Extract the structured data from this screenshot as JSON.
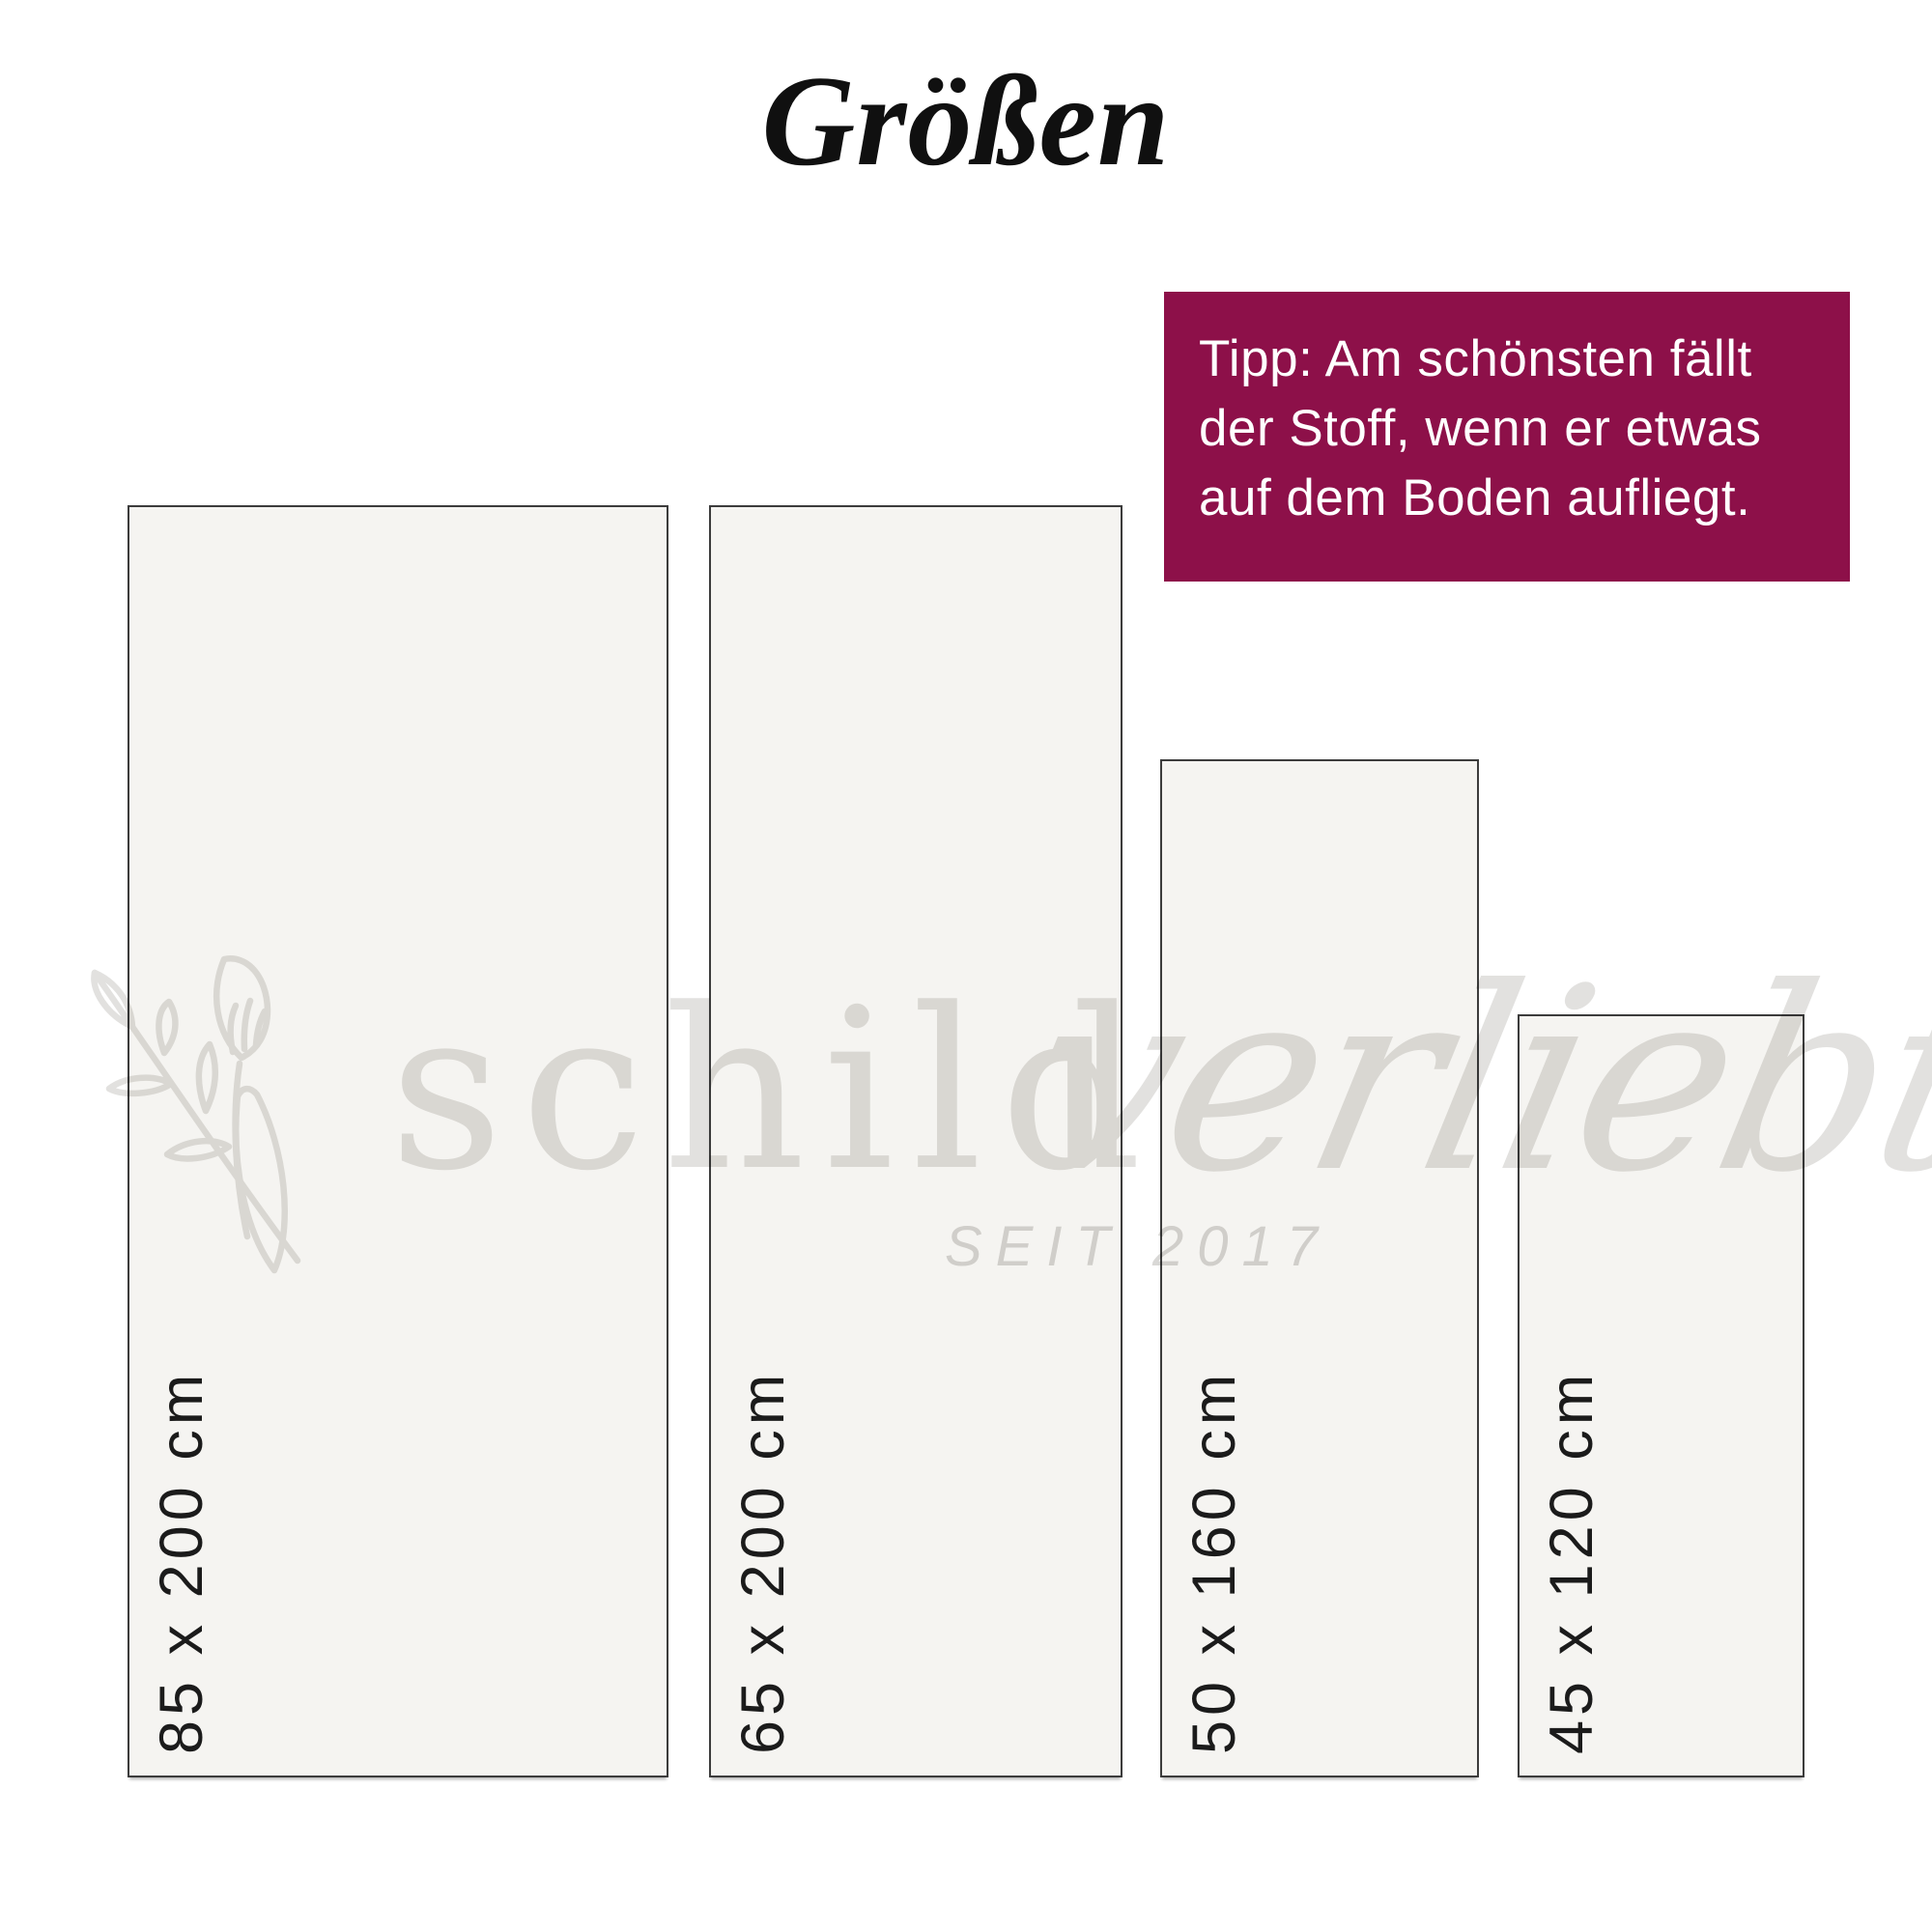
{
  "title": "Größen",
  "tip_box": {
    "background_color": "#8d1049",
    "text_color": "#ffffff",
    "lines": [
      "Tipp: Am schönsten fällt",
      "der Stoff, wenn er etwas",
      "auf dem Boden aufliegt."
    ]
  },
  "sizes": [
    {
      "label": "85 x 200 cm",
      "width_cm": 85,
      "height_cm": 200
    },
    {
      "label": "65 x 200 cm",
      "width_cm": 65,
      "height_cm": 200
    },
    {
      "label": "50 x 160 cm",
      "width_cm": 50,
      "height_cm": 160
    },
    {
      "label": "45 x 120 cm",
      "width_cm": 45,
      "height_cm": 120
    }
  ],
  "watermark": {
    "brand": "schildverliebt",
    "brand_part_serif": "schild",
    "brand_part_script": "verliebt",
    "tagline": "SEIT 2017",
    "color": "#e2e1df"
  },
  "colors": {
    "page_background": "#ffffff",
    "rect_fill": "#f5f4f1",
    "rect_border": "#3c3c3c",
    "label_text": "#1b1b1b",
    "title_text": "#101010"
  }
}
